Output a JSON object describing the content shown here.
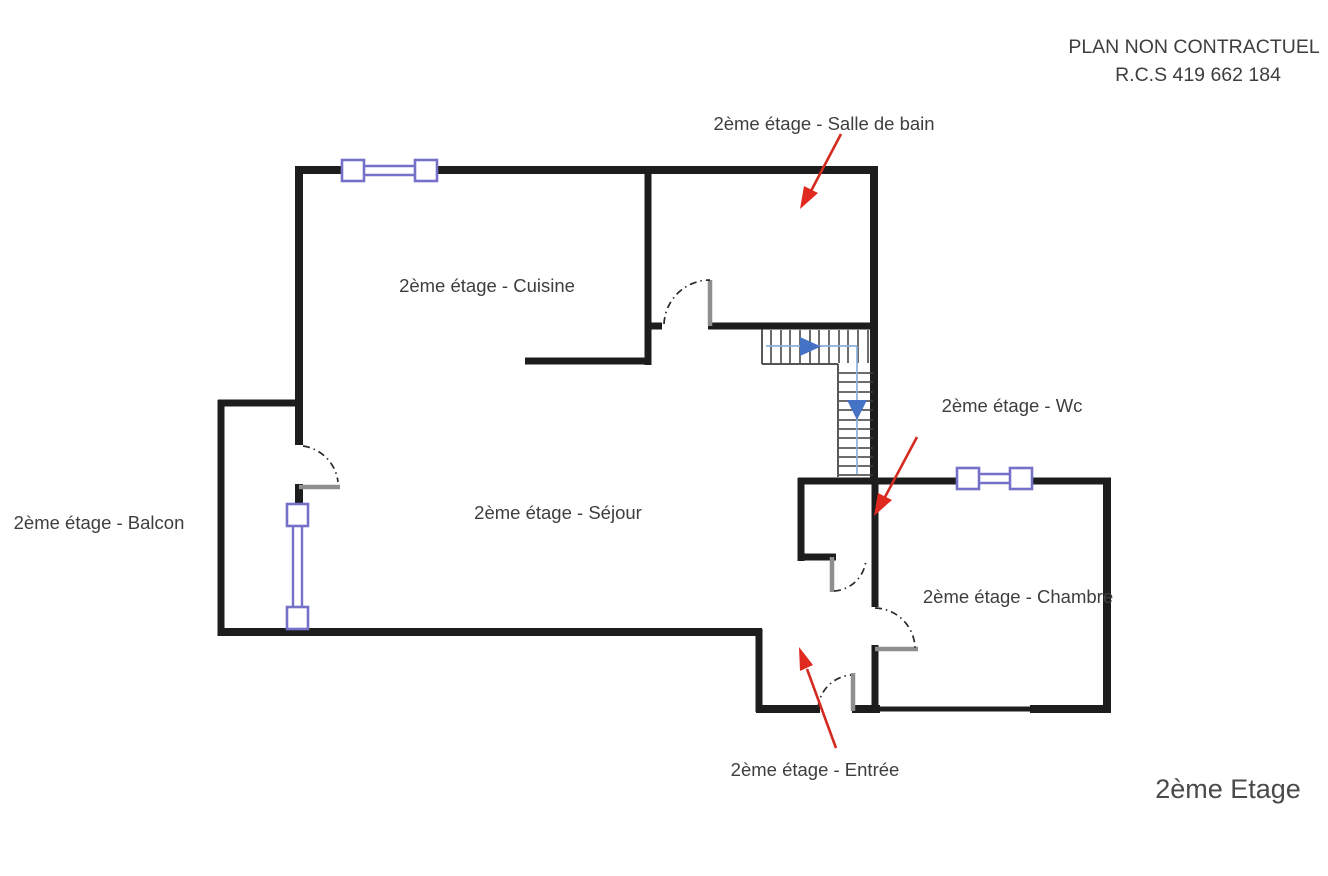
{
  "header": {
    "line1": "PLAN NON CONTRACTUEL",
    "line2": "R.C.S 419 662 184"
  },
  "floor_title": "2ème Etage",
  "rooms": {
    "salle_de_bain": {
      "label": "2ème étage - Salle de bain",
      "annotated_by": "red-arrow"
    },
    "cuisine": {
      "label": "2ème étage - Cuisine"
    },
    "wc": {
      "label": "2ème étage - Wc",
      "annotated_by": "red-arrow"
    },
    "balcon": {
      "label": "2ème étage - Balcon"
    },
    "sejour": {
      "label": "2ème étage - Séjour"
    },
    "chambre": {
      "label": "2ème étage - Chambre"
    },
    "entree": {
      "label": "2ème étage - Entrée",
      "annotated_by": "red-arrow"
    }
  },
  "symbols": {
    "windows": [
      {
        "name": "kitchen-top-window",
        "wall": "top",
        "orientation": "horizontal"
      },
      {
        "name": "balcony-window",
        "wall": "left",
        "orientation": "vertical"
      },
      {
        "name": "chamber-top-window",
        "wall": "wc-chamber-top",
        "orientation": "horizontal"
      }
    ],
    "doors": [
      {
        "name": "bathroom-door"
      },
      {
        "name": "balcony-door"
      },
      {
        "name": "wc-door"
      },
      {
        "name": "chamber-door"
      },
      {
        "name": "entrance-door"
      }
    ],
    "stairs": {
      "flights": 2,
      "arrows": [
        "right",
        "down"
      ]
    },
    "red_arrows": [
      {
        "points_to": "salle_de_bain"
      },
      {
        "points_to": "wc"
      },
      {
        "points_to": "entree"
      }
    ]
  },
  "colors": {
    "wall": "#1d1d1d",
    "door": "#8f8f8f",
    "window": "#7571c9",
    "stair_line": "#3c3c3c",
    "stair_guide": "#8ab1dd",
    "arrow_blue": "#4472c4",
    "arrow_red": "#d32b20",
    "text": "#3e3e3e",
    "background": "#ffffff"
  }
}
